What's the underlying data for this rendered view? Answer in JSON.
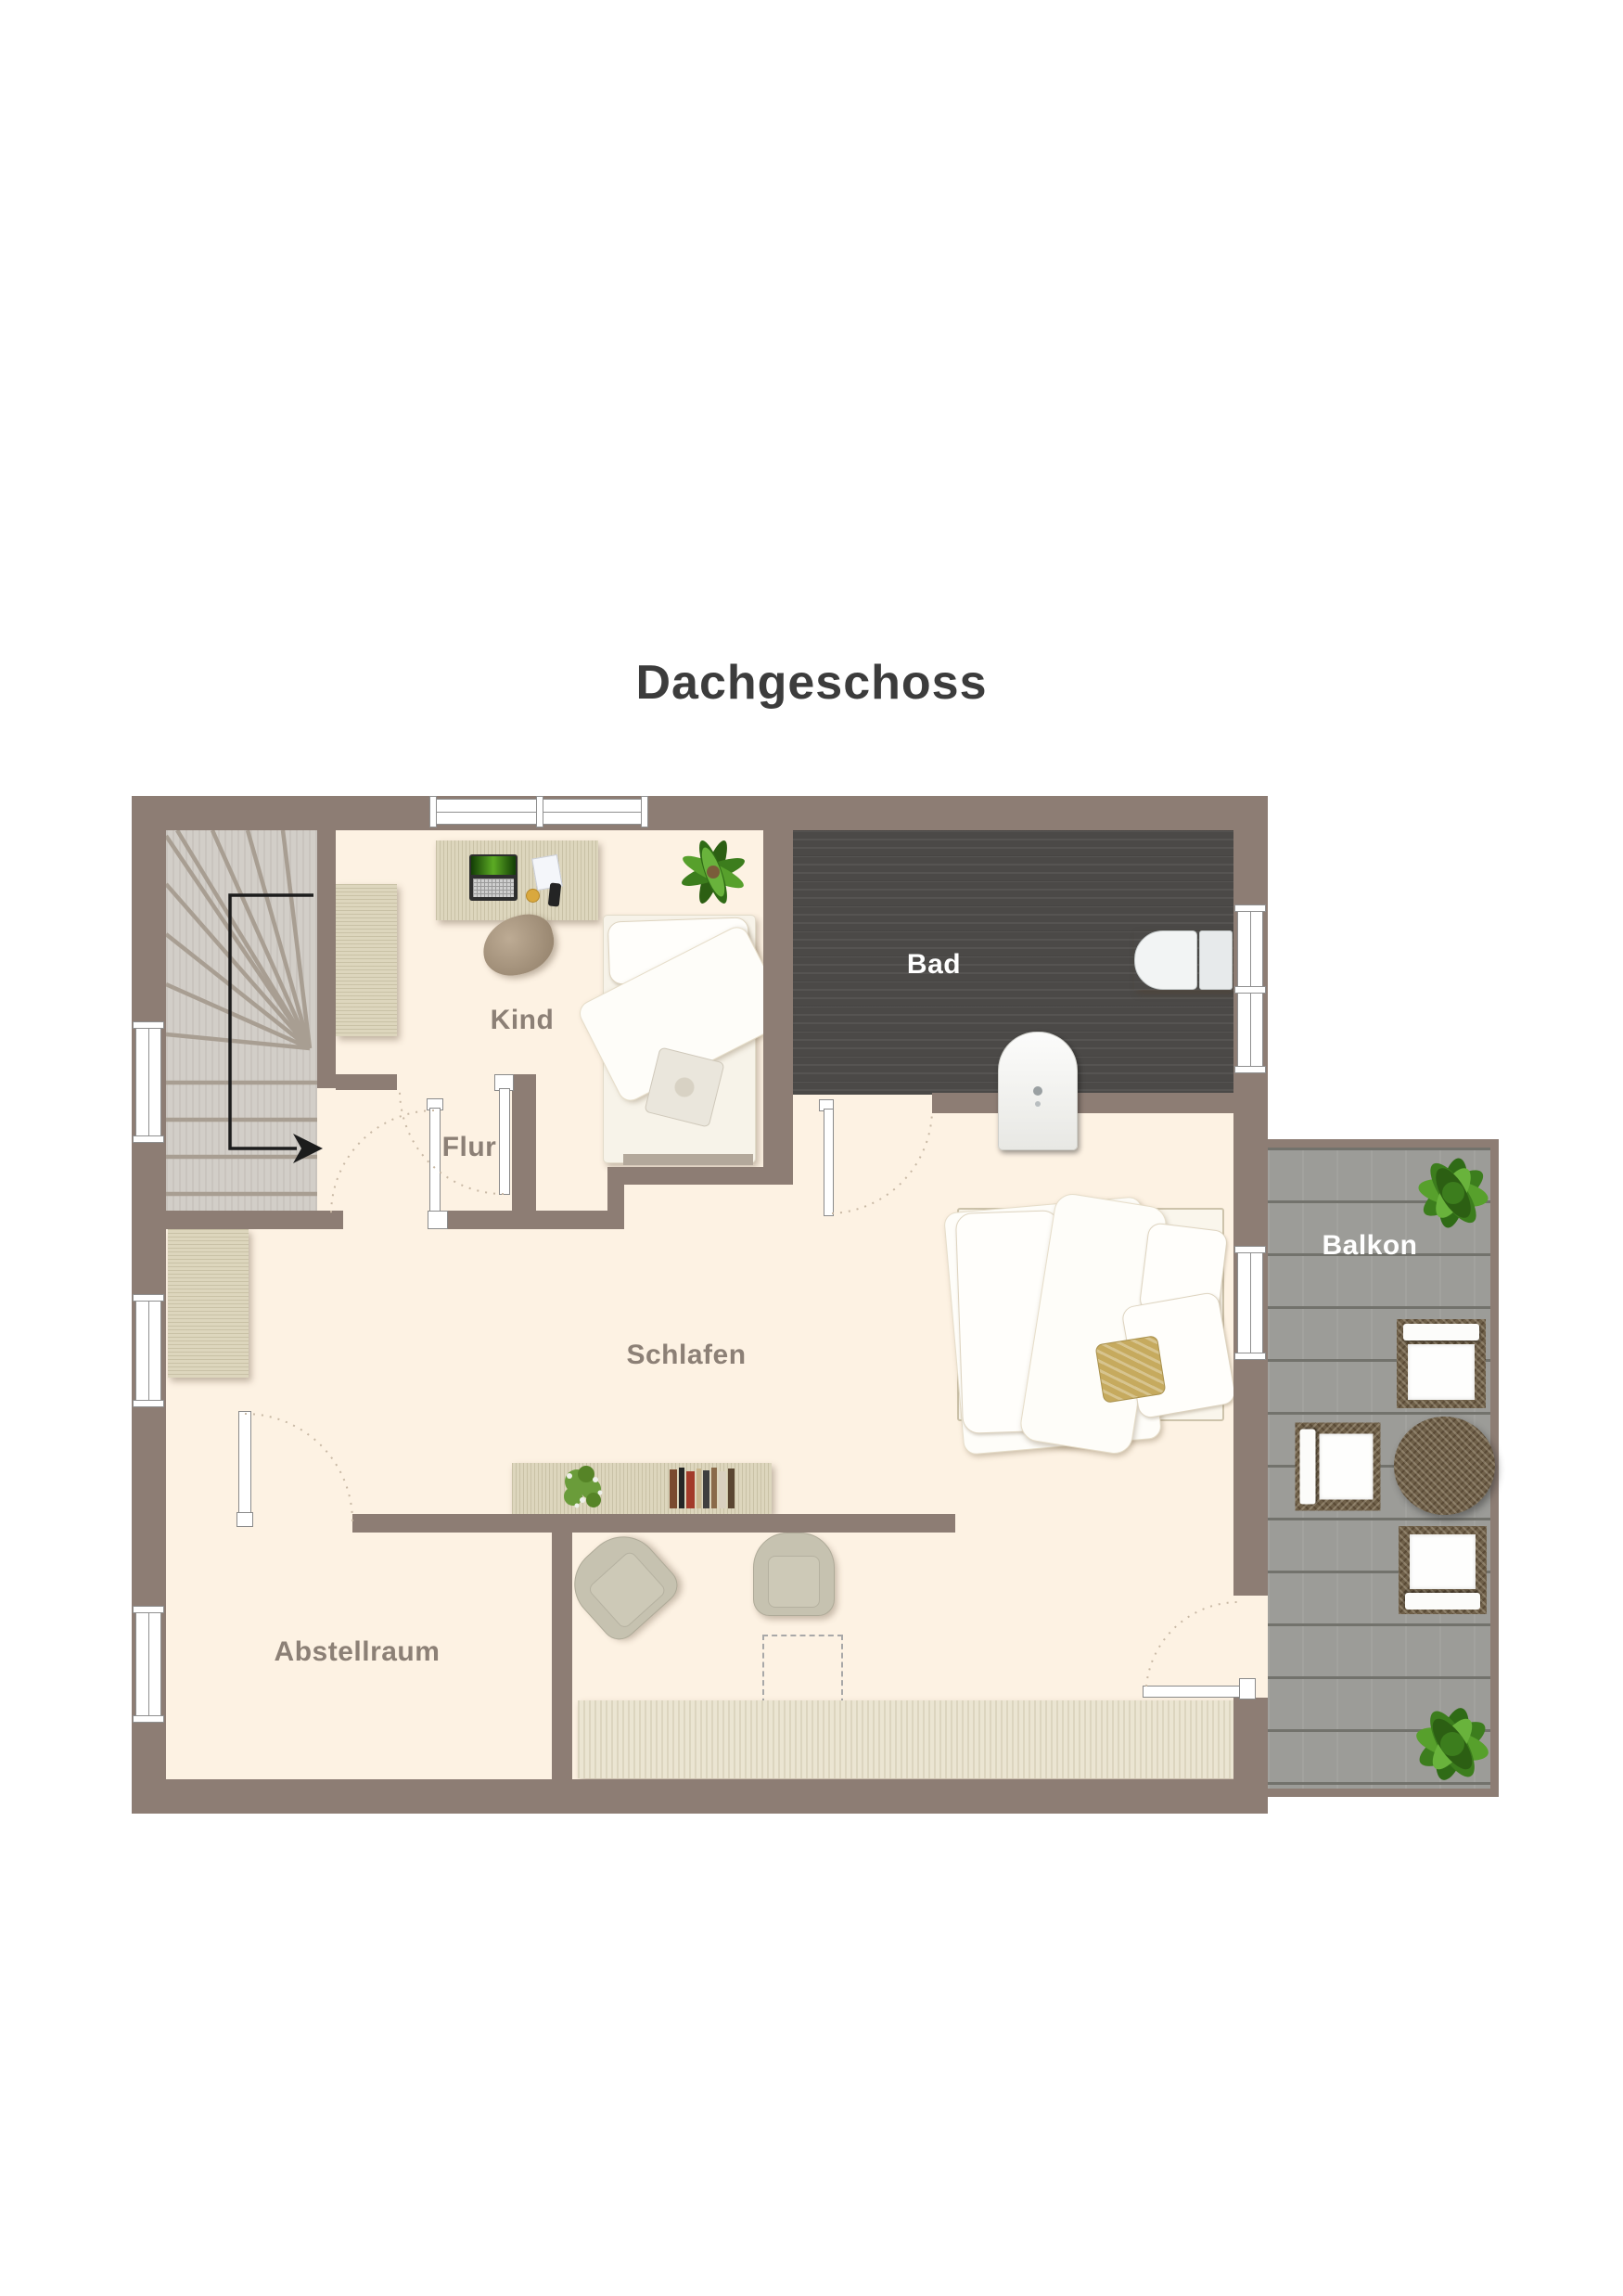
{
  "title": "Dachgeschoss",
  "rooms": {
    "kind": {
      "label": "Kind"
    },
    "flur": {
      "label": "Flur"
    },
    "bad": {
      "label": "Bad"
    },
    "schlafen": {
      "label": "Schlafen"
    },
    "abstellraum": {
      "label": "Abstellraum"
    },
    "balkon": {
      "label": "Balkon"
    }
  },
  "colors": {
    "heading": "#3c3c3c",
    "wall": "#8d7d74",
    "floor": "#fdf2e3",
    "stairs": "#d2cec8",
    "tread": "#a89e92",
    "bath": "#4b4947",
    "deck": "#9c9c98",
    "deckline": "#72726c",
    "wood": "#ddd6bd",
    "rug": "#ebe5d2",
    "wicker": "#6f6049",
    "labeldim": "#8c8076",
    "labellight": "#ffffff",
    "ink": "#1c1c1c"
  }
}
